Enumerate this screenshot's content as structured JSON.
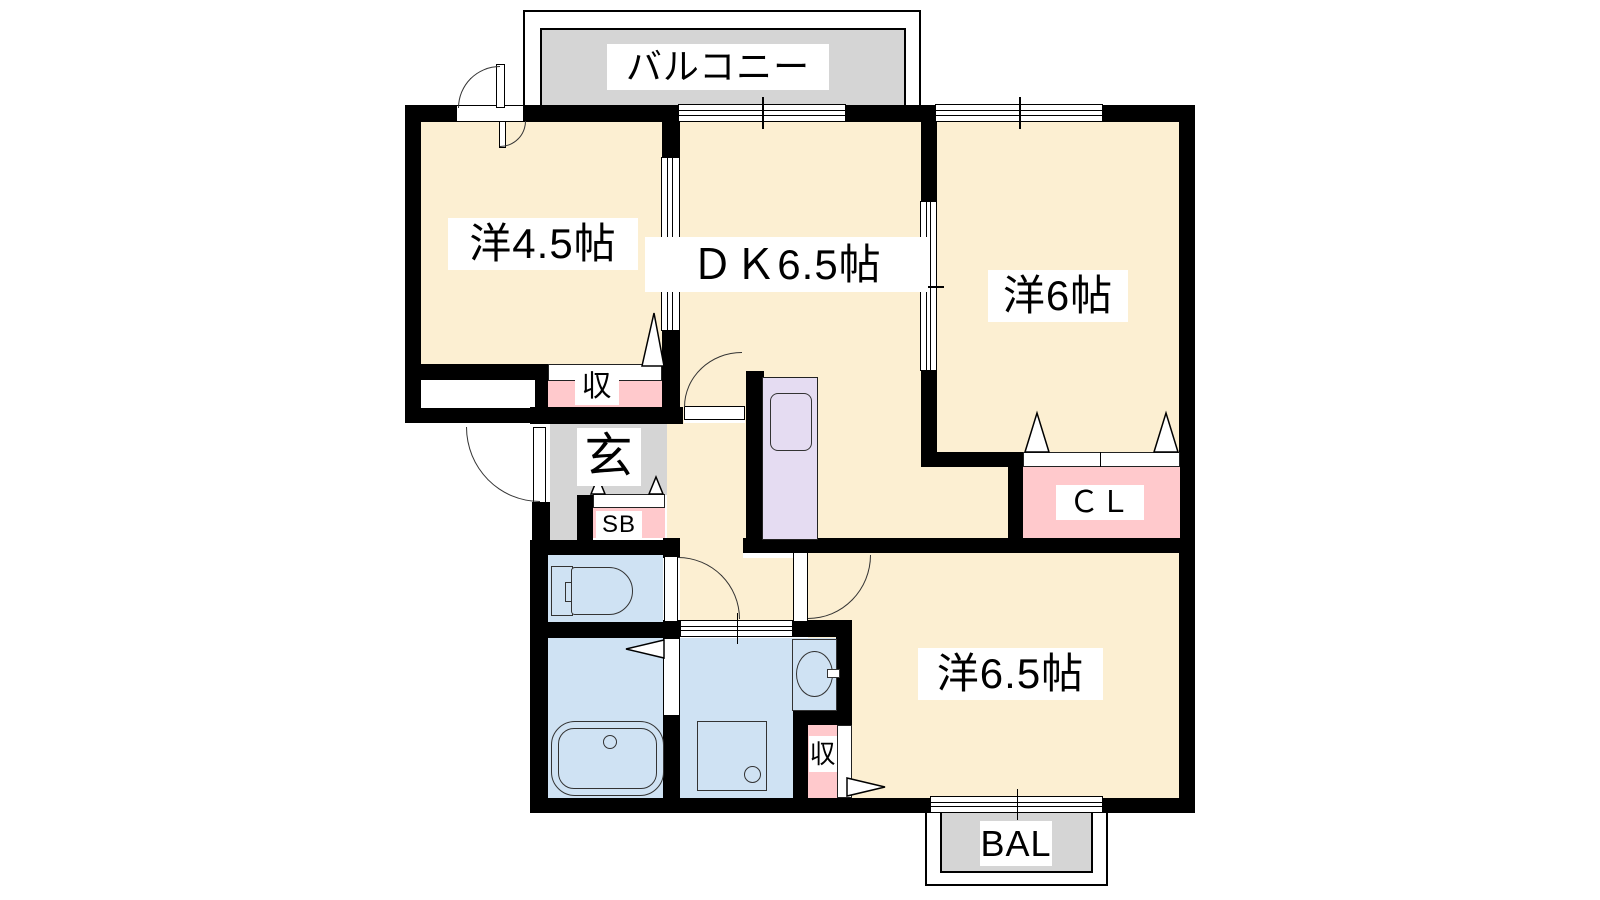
{
  "floorplan": {
    "labels": {
      "balcony_top": "バルコニー",
      "room_45": "洋4.5帖",
      "dk": "ＤＫ6.5帖",
      "room_6": "洋6帖",
      "room_65": "洋6.5帖",
      "entrance": "玄",
      "storage_45": "収",
      "shoe_box": "SB",
      "closet": "ＣＬ",
      "storage_65": "収",
      "balcony_bottom": "BAL"
    },
    "colors": {
      "wall": "#000000",
      "room_floor": "#FCEFD2",
      "balcony": "#D5D5D5",
      "entrance_floor": "#D5D5D5",
      "closet_fill": "#FFC9CC",
      "wet_area_fill": "#CFE2F3",
      "kitchen_unit_fill": "#E5DCF2"
    }
  }
}
